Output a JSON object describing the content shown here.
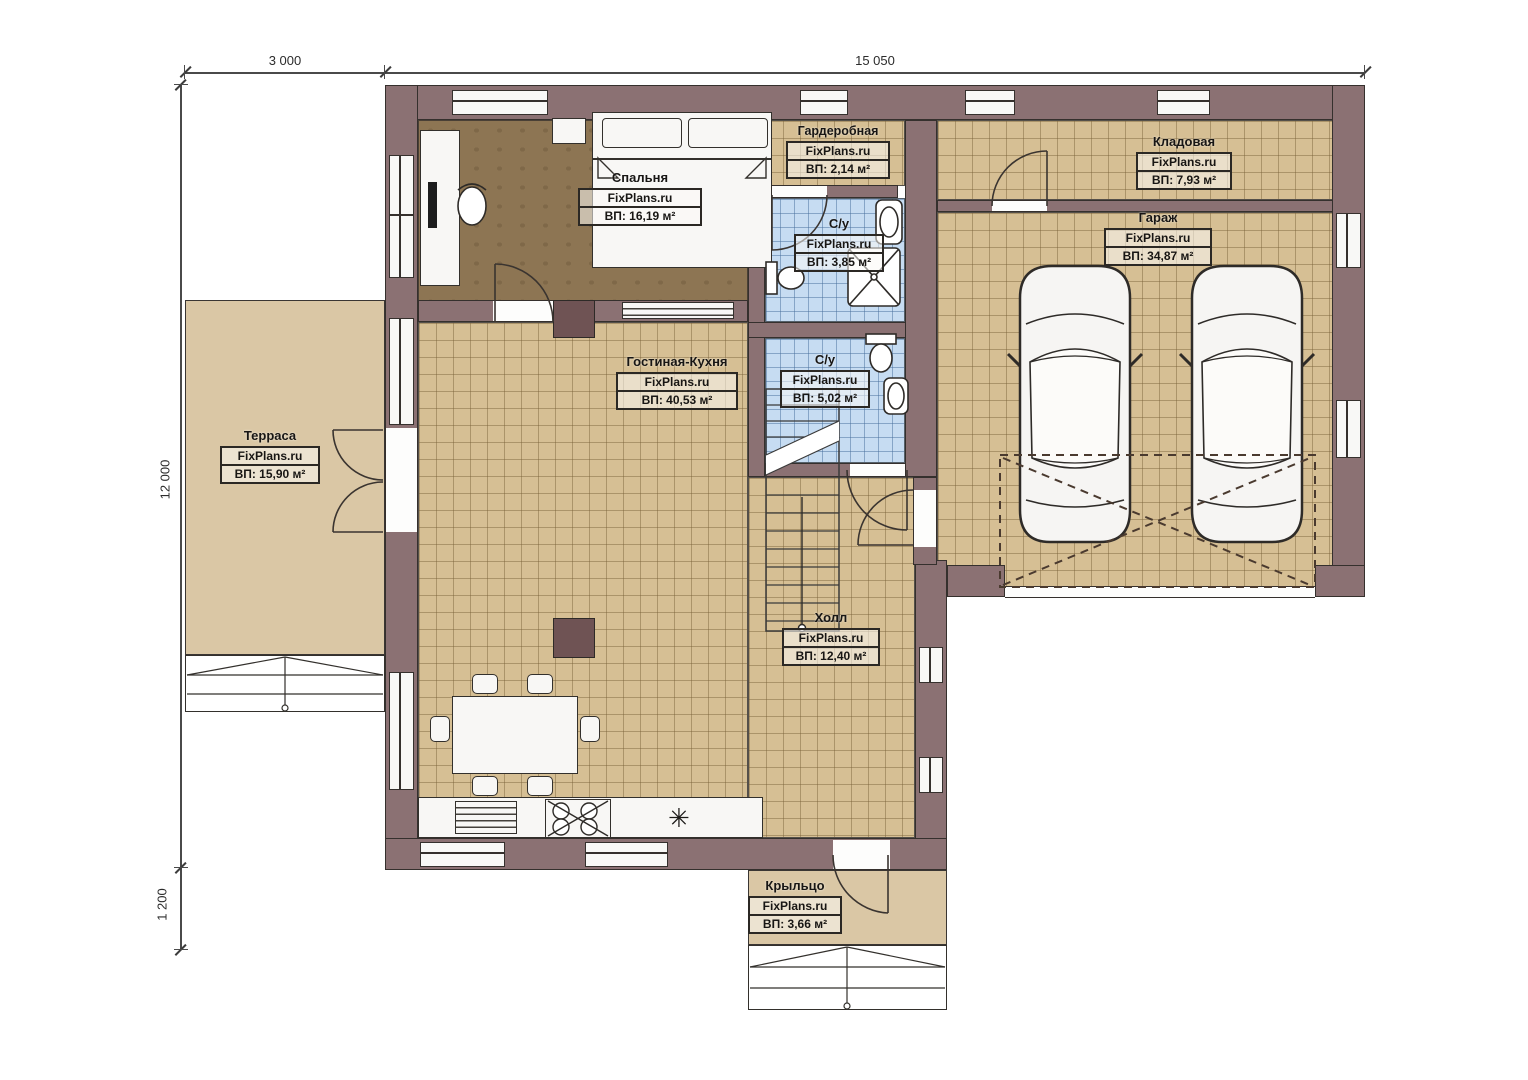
{
  "watermark": "FixPlans.ru",
  "dimensions": {
    "terrace_width": "3 000",
    "house_width": "15 050",
    "house_height": "12 000",
    "porch_height": "1 200"
  },
  "rooms": {
    "bedroom": {
      "name": "Спальня",
      "area": "ВП: 16,19 м²"
    },
    "wardrobe": {
      "name": "Гардеробная",
      "area": "ВП: 2,14 м²"
    },
    "bathroom1": {
      "name": "С/у",
      "area": "ВП: 3,85 м²"
    },
    "storage": {
      "name": "Кладовая",
      "area": "ВП: 7,93 м²"
    },
    "garage": {
      "name": "Гараж",
      "area": "ВП: 34,87 м²"
    },
    "bathroom2": {
      "name": "С/у",
      "area": "ВП: 5,02 м²"
    },
    "living_kitchen": {
      "name": "Гостиная-Кухня",
      "area": "ВП: 40,53 м²"
    },
    "terrace": {
      "name": "Терраса",
      "area": "ВП: 15,90 м²"
    },
    "hall": {
      "name": "Холл",
      "area": "ВП: 12,40 м²"
    },
    "porch": {
      "name": "Крыльцо",
      "area": "ВП: 3,66 м²"
    }
  },
  "colors": {
    "wall": "#8b7173",
    "outline": "#35302d",
    "floor_tile": "#d6bf94",
    "floor_wet": "#c6dcf2",
    "floor_bedroom": "#8d7553",
    "floor_outdoor": "#dac7a5"
  }
}
